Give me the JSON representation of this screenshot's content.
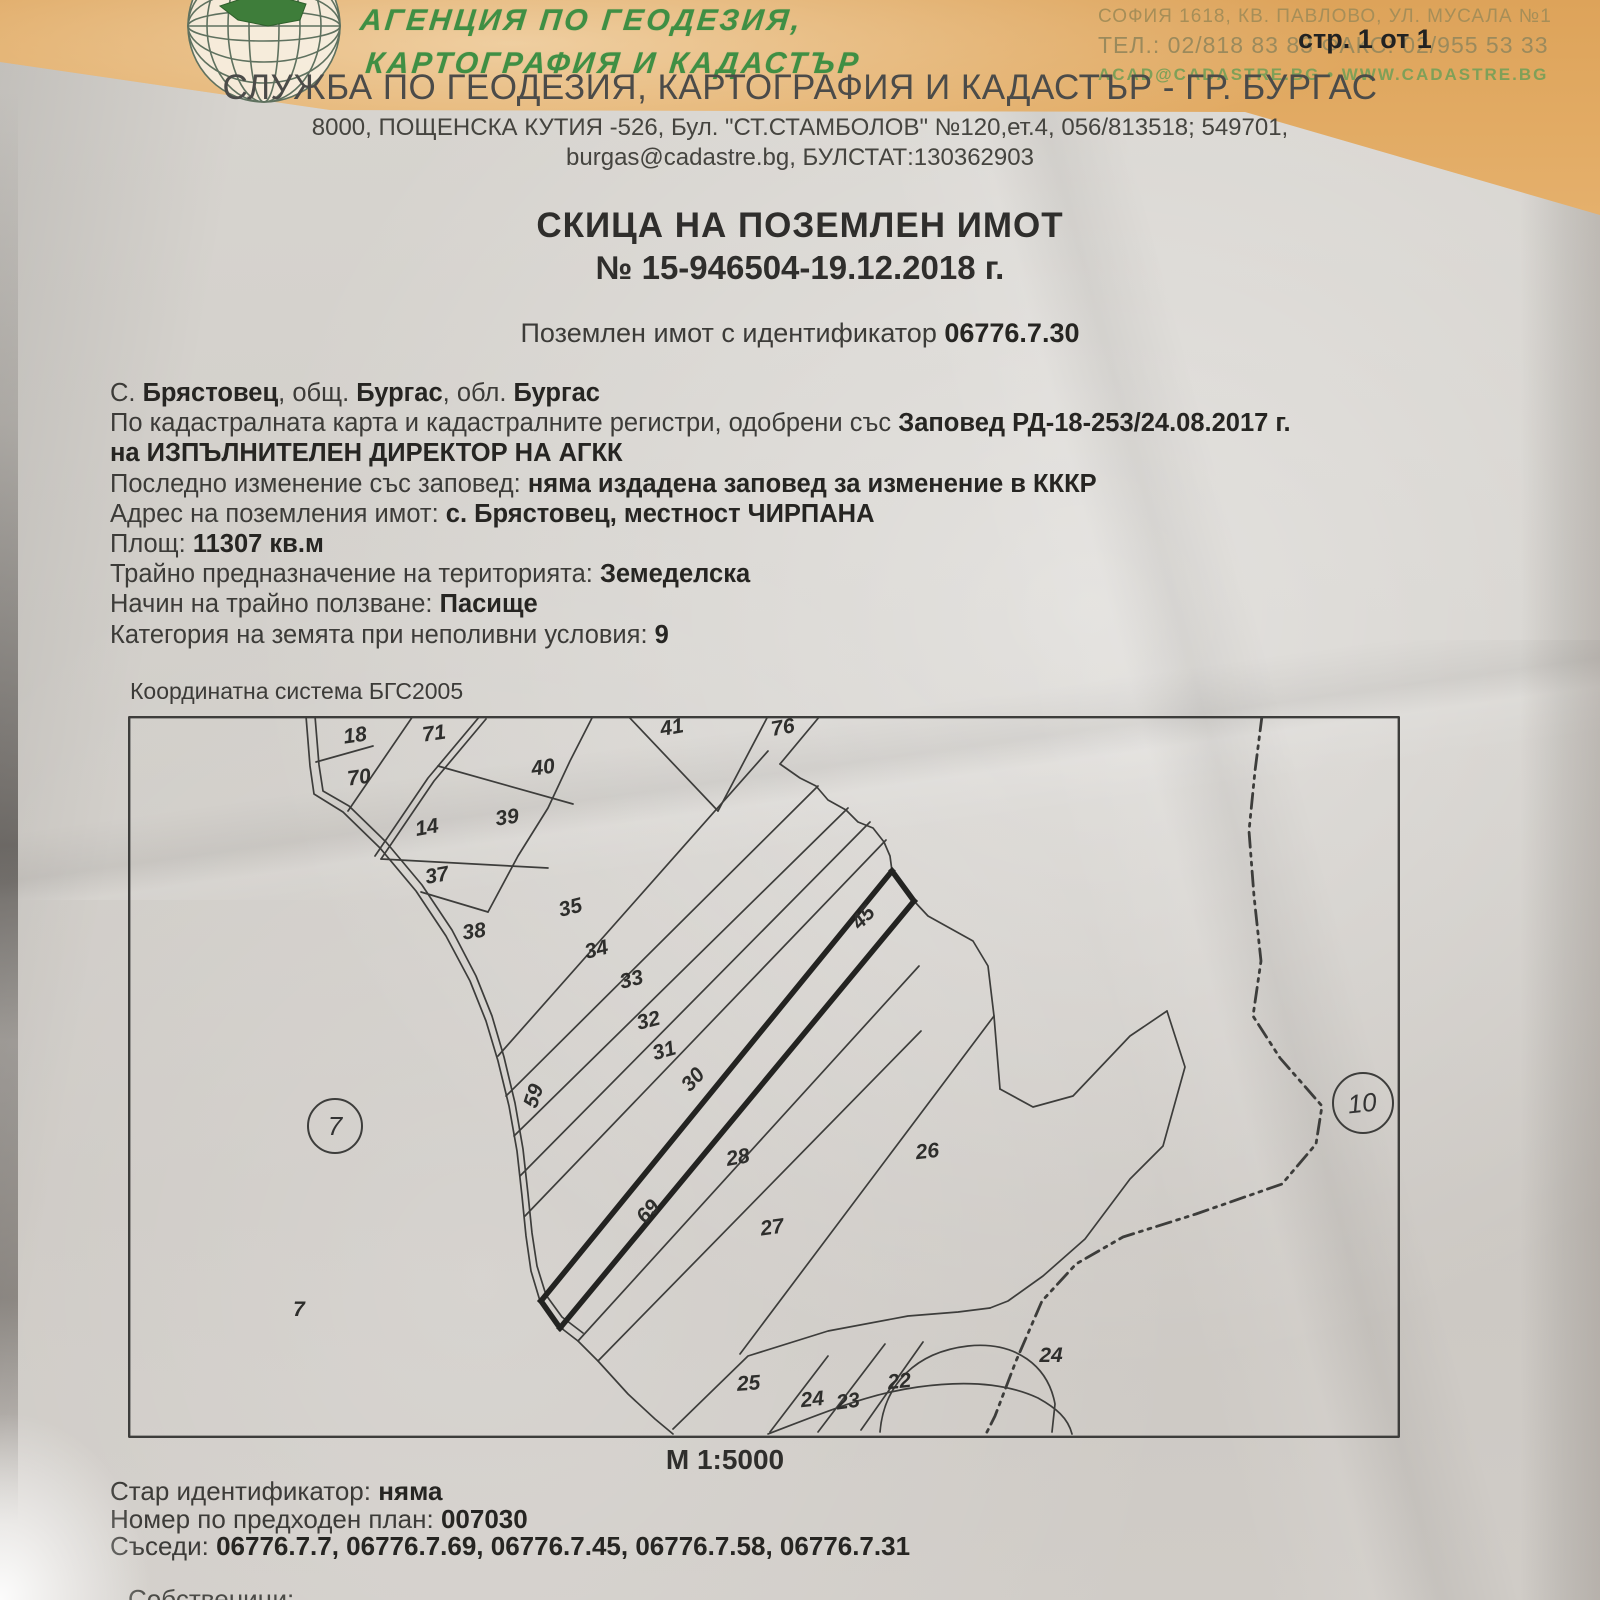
{
  "header": {
    "agency_name_line1": "АГЕНЦИЯ ПО ГЕОДЕЗИЯ,",
    "agency_name_line2": "КАРТОГРАФИЯ И КАДАСТЪР",
    "hq_address": "СОФИЯ 1618, КВ. ПАВЛОВО, УЛ. МУСАЛА №1",
    "hq_phone": "ТЕЛ.: 02/818 83 83   ФАКС: 02/955 53 33",
    "hq_web": "ACAD@CADASTRE.BG  •  WWW.CADASTRE.BG",
    "page_indicator": "стр. 1 от 1",
    "office_title": "СЛУЖБА ПО ГЕОДЕЗИЯ, КАРТОГРАФИЯ И КАДАСТЪР - ГР. БУРГАС",
    "office_address_line1": "8000, ПОЩЕНСКА КУТИЯ -526, Бул. \"СТ.СТАМБОЛОВ\" №120,ет.4, 056/813518; 549701,",
    "office_address_line2": "burgas@cadastre.bg, БУЛСТАТ:130362903"
  },
  "document": {
    "title": "СКИЦА НА ПОЗЕМЛЕН ИМОТ",
    "number": "№ 15-946504-19.12.2018 г.",
    "subtitle_prefix": "Поземлен имот с  идентификатор ",
    "identifier": "06776.7.30"
  },
  "properties": {
    "lines": [
      [
        [
          "С. ",
          0
        ],
        [
          "Брястовец",
          1
        ],
        [
          ", общ. ",
          0
        ],
        [
          "Бургас",
          1
        ],
        [
          ", обл. ",
          0
        ],
        [
          "Бургас",
          1
        ]
      ],
      [
        [
          "По кадастралната карта и кадастралните регистри, одобрени със ",
          0
        ],
        [
          "Заповед РД-18-253/24.08.2017 г.",
          1
        ]
      ],
      [
        [
          "на ИЗПЪЛНИТЕЛЕН ДИРЕКТОР НА АГКК",
          1
        ]
      ],
      [
        [
          "Последно изменение със заповед: ",
          0
        ],
        [
          "няма издадена заповед за изменение в КККР",
          1
        ]
      ],
      [
        [
          "Адрес на поземления имот: ",
          0
        ],
        [
          "с. Брястовец, местност ЧИРПАНА",
          1
        ]
      ],
      [
        [
          "Площ: ",
          0
        ],
        [
          "11307 кв.м",
          1
        ]
      ],
      [
        [
          "Трайно предназначение на територията: ",
          0
        ],
        [
          "Земеделска",
          1
        ]
      ],
      [
        [
          "Начин на трайно ползване: ",
          0
        ],
        [
          "Пасище",
          1
        ]
      ],
      [
        [
          "Категория на земята при неполивни условия: ",
          0
        ],
        [
          "9",
          1
        ]
      ]
    ]
  },
  "map": {
    "coord_system": "Координатна система БГС2005",
    "scale": "М 1:5000",
    "subject_parcel": "30",
    "labels": [
      {
        "text": "18"
      },
      {
        "text": "70"
      },
      {
        "text": "71"
      },
      {
        "text": "40"
      },
      {
        "text": "39"
      },
      {
        "text": "14"
      },
      {
        "text": "37"
      },
      {
        "text": "38"
      },
      {
        "text": "41"
      },
      {
        "text": "76"
      },
      {
        "text": "35"
      },
      {
        "text": "34"
      },
      {
        "text": "33"
      },
      {
        "text": "32"
      },
      {
        "text": "31"
      },
      {
        "text": "30"
      },
      {
        "text": "45"
      },
      {
        "text": "59"
      },
      {
        "text": "69"
      },
      {
        "text": "28"
      },
      {
        "text": "27"
      },
      {
        "text": "26"
      },
      {
        "text": "25"
      },
      {
        "text": "24"
      },
      {
        "text": "23"
      },
      {
        "text": "22"
      },
      {
        "text": "24"
      },
      {
        "text": "7"
      },
      {
        "text": "10"
      },
      {
        "text": "7"
      }
    ]
  },
  "footer": {
    "lines": [
      [
        [
          "Стар идентификатор: ",
          0
        ],
        [
          "няма",
          1
        ]
      ],
      [
        [
          "Номер по предходен план: ",
          0
        ],
        [
          "007030",
          1
        ]
      ],
      [
        [
          "Съседи: ",
          0
        ],
        [
          "06776.7.7, 06776.7.69, 06776.7.45, 06776.7.58, 06776.7.31",
          1
        ]
      ]
    ],
    "partial_line": "Собственици:"
  }
}
